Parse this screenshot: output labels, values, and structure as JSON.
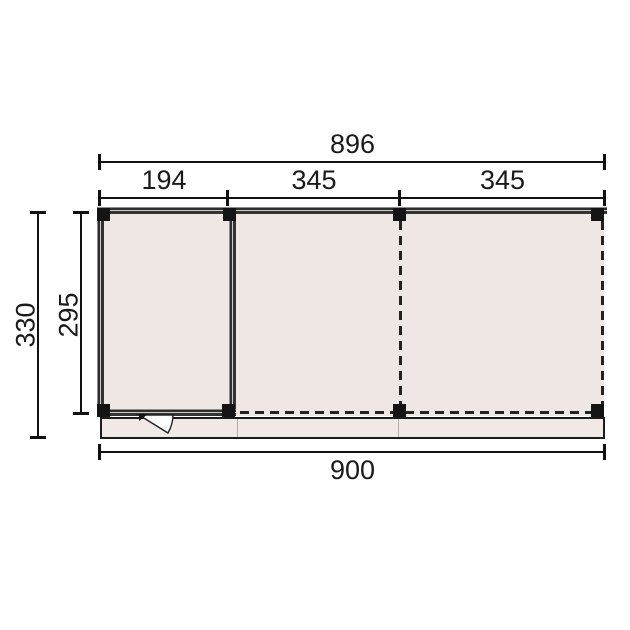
{
  "diagram": {
    "type": "floor-plan",
    "description": "Technical top-view plan of a flat-roof garden building: one enclosed room on the left and two open bays marked with posts and dashed lines, with a front decking strip and a door swing in the room front wall.",
    "dimensions": {
      "top_total": "896",
      "segments": [
        "194",
        "345",
        "345"
      ],
      "side_outer": "330",
      "side_inner": "295",
      "bottom_total": "900"
    },
    "colors": {
      "background": "#ffffff",
      "floor_fill": "#efe7e3",
      "strip_fill": "#f0e9e5",
      "wall_dark": "#2e2e2e",
      "wall_light": "#c9c9c9",
      "post": "#141414",
      "line": "#111111"
    }
  }
}
